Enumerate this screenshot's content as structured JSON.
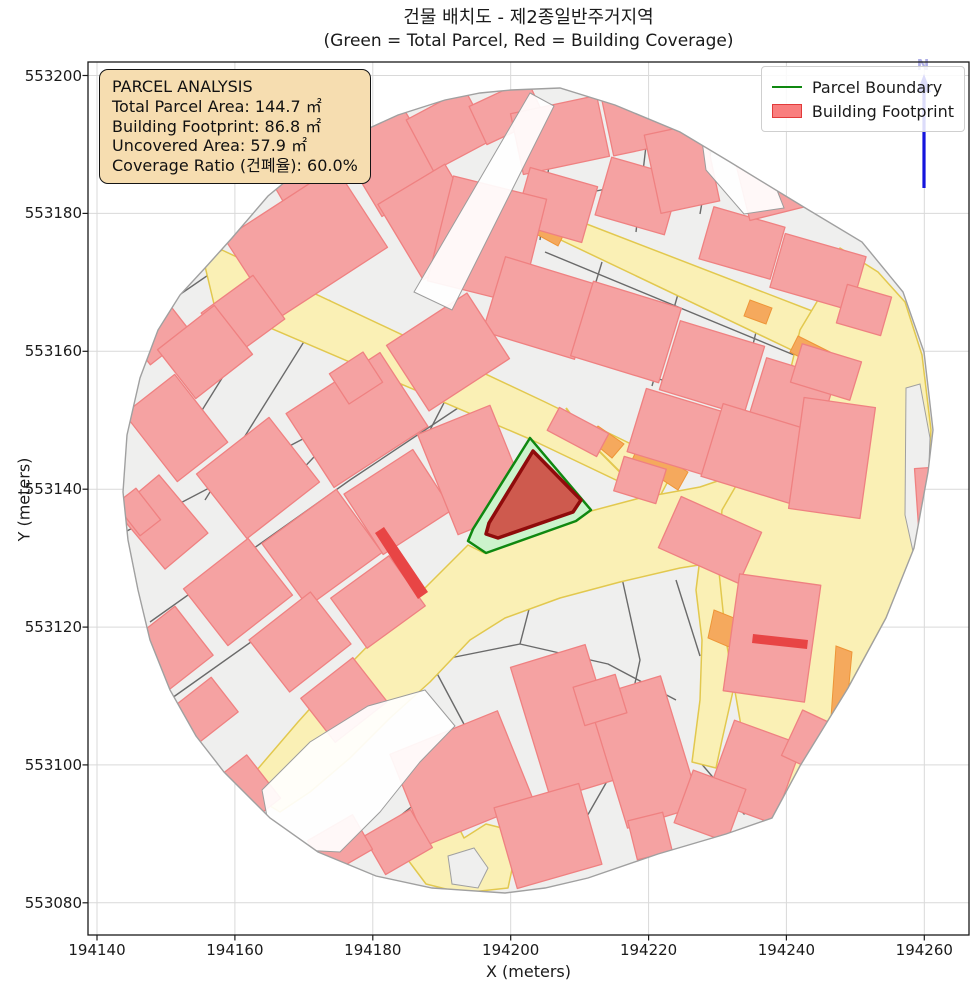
{
  "title": {
    "line1": "건물 배치도 - 제2종일반주거지역",
    "line2": "(Green = Total Parcel, Red = Building Coverage)"
  },
  "axes": {
    "xlabel": "X (meters)",
    "ylabel": "Y (meters)",
    "x_ticks": [
      {
        "label": "194140",
        "px": 97.0
      },
      {
        "label": "194160",
        "px": 234.9
      },
      {
        "label": "194180",
        "px": 372.8
      },
      {
        "label": "194200",
        "px": 510.7
      },
      {
        "label": "194220",
        "px": 648.6
      },
      {
        "label": "194240",
        "px": 786.4
      },
      {
        "label": "194260",
        "px": 924.3
      }
    ],
    "y_ticks": [
      {
        "label": "553200",
        "px": 75.5
      },
      {
        "label": "553180",
        "px": 213.4
      },
      {
        "label": "553160",
        "px": 351.3
      },
      {
        "label": "553140",
        "px": 489.2
      },
      {
        "label": "553120",
        "px": 627.1
      },
      {
        "label": "553100",
        "px": 764.9
      },
      {
        "label": "553080",
        "px": 902.8
      }
    ]
  },
  "legend": {
    "items": [
      {
        "label": "Parcel Boundary",
        "swatch": "line"
      },
      {
        "label": "Building Footprint",
        "swatch": "patch"
      }
    ]
  },
  "info_box": {
    "title": "PARCEL ANALYSIS",
    "lines": [
      "Total Parcel Area: 144.7 ㎡",
      "Building Footprint: 86.8 ㎡",
      "Uncovered Area: 57.9 ㎡",
      "Coverage Ratio (건폐율): 60.0%"
    ]
  },
  "north_label": "N",
  "theme": {
    "grid": "#d9d9d9",
    "base": "#efefee",
    "edge": "#a0a0a0",
    "street": "#6a6a6a",
    "road": "#faf0b5",
    "roadedge": "#e2c84e",
    "orange": "#f5a95d",
    "orangeedge": "#ee9537",
    "bld": "#f5a2a2",
    "bldedge": "#ef8181",
    "redsliver": "#e84545",
    "pgreen": "#ccf3cc",
    "pgreenedge": "#0f8810",
    "hbld": "#ce5a4e",
    "hbldedge": "#8f0b0b",
    "legbld": "#f97e7e",
    "legbldedge": "#e23b3b",
    "infobg": "#f6ddb0",
    "narrow": "#1515dd"
  },
  "map": {
    "boundary": [
      511,
      90,
      560,
      88,
      615,
      105,
      680,
      132,
      730,
      162,
      807,
      209,
      862,
      242,
      903,
      292,
      924,
      352,
      933,
      430,
      928,
      472,
      914,
      548,
      886,
      618,
      848,
      688,
      800,
      766,
      772,
      818,
      726,
      834,
      658,
      854,
      588,
      878,
      545,
      888,
      505,
      893,
      432,
      888,
      376,
      876,
      318,
      852,
      270,
      818,
      224,
      772,
      196,
      736,
      170,
      690,
      150,
      640,
      138,
      590,
      128,
      540,
      123,
      492,
      127,
      435,
      140,
      378,
      158,
      330,
      180,
      295,
      205,
      268,
      232,
      238,
      268,
      196,
      308,
      163,
      352,
      136,
      398,
      115,
      445,
      100,
      480,
      93
    ],
    "streets": [
      [
        150,
        315,
        300,
        212,
        450,
        115
      ],
      [
        210,
        196,
        250,
        262
      ],
      [
        320,
        140,
        360,
        225
      ],
      [
        430,
        108,
        395,
        180
      ],
      [
        512,
        208,
        700,
        170
      ],
      [
        556,
        106,
        540,
        240
      ],
      [
        652,
        94,
        636,
        232
      ],
      [
        716,
        122,
        700,
        214
      ],
      [
        545,
        252,
        840,
        374
      ],
      [
        562,
        338,
        852,
        460
      ],
      [
        602,
        262,
        574,
        354
      ],
      [
        678,
        294,
        652,
        386
      ],
      [
        758,
        324,
        736,
        414
      ],
      [
        826,
        352,
        808,
        442
      ],
      [
        125,
        532,
        320,
        430,
        462,
        352
      ],
      [
        150,
        622,
        350,
        480,
        470,
        400
      ],
      [
        172,
        698,
        420,
        522,
        468,
        486
      ],
      [
        252,
        330,
        176,
        452
      ],
      [
        330,
        300,
        250,
        428,
        205,
        500
      ],
      [
        398,
        338,
        330,
        440,
        262,
        512
      ],
      [
        465,
        362,
        430,
        430
      ],
      [
        320,
        700,
        430,
        662,
        520,
        644,
        608,
        664,
        676,
        700
      ],
      [
        520,
        644,
        534,
        590
      ],
      [
        618,
        560,
        640,
        660,
        618,
        762,
        562,
        860
      ],
      [
        676,
        580,
        700,
        656
      ],
      [
        432,
        664,
        466,
        728
      ],
      [
        352,
        854,
        420,
        800,
        466,
        770
      ],
      [
        756,
        560,
        830,
        602,
        866,
        652
      ],
      [
        820,
        608,
        790,
        700,
        772,
        760
      ],
      [
        700,
        762,
        744,
        814,
        788,
        790
      ],
      [
        447,
        280,
        540,
        306
      ]
    ],
    "roads": [
      [
        204,
        262,
        222,
        250,
        545,
        402,
        676,
        466,
        658,
        500,
        532,
        440,
        214,
        304
      ],
      [
        540,
        206,
        820,
        314,
        842,
        330,
        800,
        354,
        544,
        232
      ],
      [
        744,
        472,
        722,
        512,
        718,
        562,
        680,
        568,
        620,
        582,
        560,
        598,
        505,
        618,
        470,
        640,
        430,
        682,
        390,
        718,
        350,
        758,
        310,
        792,
        280,
        812,
        252,
        795,
        250,
        778,
        298,
        722,
        352,
        662,
        405,
        608,
        445,
        568,
        468,
        545,
        484,
        553,
        540,
        532,
        591,
        511,
        640,
        498,
        700,
        487
      ],
      [
        700,
        558,
        738,
        556,
        748,
        600,
        740,
        660,
        722,
        740,
        716,
        768,
        692,
        762,
        700,
        700,
        702,
        640,
        696,
        590
      ],
      [
        408,
        860,
        444,
        820,
        454,
        818,
        464,
        838,
        486,
        824,
        502,
        828,
        514,
        860,
        508,
        888,
        462,
        893,
        426,
        884
      ],
      [
        840,
        248,
        878,
        272,
        905,
        302,
        922,
        355,
        931,
        430,
        928,
        472,
        915,
        548,
        886,
        618,
        848,
        688,
        800,
        766,
        774,
        818,
        750,
        800,
        740,
        720,
        726,
        640,
        718,
        562,
        722,
        510,
        744,
        472,
        770,
        425,
        788,
        380,
        800,
        330,
        818,
        300,
        828,
        270
      ]
    ],
    "yellow_lines": [
      [
        566,
        408,
        592,
        444,
        636,
        488
      ]
    ],
    "orange": [
      [
        540,
        220,
        566,
        230,
        558,
        246,
        536,
        234
      ],
      [
        750,
        300,
        772,
        308,
        766,
        324,
        744,
        316
      ],
      [
        798,
        336,
        830,
        352,
        820,
        368,
        790,
        352
      ],
      [
        598,
        426,
        624,
        444,
        612,
        458,
        588,
        438
      ],
      [
        640,
        443,
        688,
        472,
        678,
        490,
        632,
        460
      ],
      [
        851,
        406,
        865,
        410,
        860,
        474,
        847,
        470
      ],
      [
        682,
        508,
        748,
        528,
        742,
        546,
        676,
        526
      ],
      [
        714,
        610,
        744,
        622,
        736,
        650,
        708,
        638
      ],
      [
        836,
        646,
        852,
        652,
        844,
        738,
        830,
        732
      ],
      [
        306,
        642,
        322,
        650,
        314,
        664,
        298,
        656
      ]
    ],
    "gray_patches": [
      [
        448,
        856,
        474,
        848,
        488,
        868,
        478,
        888,
        452,
        884
      ],
      [
        906,
        388,
        920,
        384,
        930,
        438,
        927,
        515,
        914,
        556,
        905,
        515
      ]
    ],
    "buildings": [
      [
        172,
        243,
        64,
        50,
        -34
      ],
      [
        216,
        186,
        70,
        52,
        -34
      ],
      [
        310,
        168,
        80,
        50,
        -30
      ],
      [
        306,
        243,
        132,
        96,
        -33
      ],
      [
        390,
        158,
        74,
        92,
        -31
      ],
      [
        449,
        130,
        66,
        58,
        -28
      ],
      [
        434,
        222,
        78,
        88,
        -31
      ],
      [
        150,
        322,
        52,
        68,
        -38
      ],
      [
        243,
        316,
        64,
        54,
        -36
      ],
      [
        507,
        112,
        64,
        42,
        -25
      ],
      [
        560,
        135,
        88,
        62,
        -12
      ],
      [
        648,
        120,
        82,
        56,
        -12
      ],
      [
        556,
        205,
        70,
        58,
        16
      ],
      [
        638,
        196,
        72,
        60,
        16
      ],
      [
        682,
        168,
        60,
        80,
        -12
      ],
      [
        742,
        243,
        74,
        54,
        16
      ],
      [
        780,
        180,
        78,
        64,
        -14
      ],
      [
        818,
        272,
        84,
        56,
        16
      ],
      [
        864,
        310,
        46,
        40,
        16
      ],
      [
        487,
        240,
        96,
        108,
        14
      ],
      [
        540,
        308,
        96,
        78,
        17
      ],
      [
        626,
        332,
        92,
        78,
        17
      ],
      [
        712,
        368,
        88,
        72,
        17
      ],
      [
        792,
        398,
        72,
        62,
        17
      ],
      [
        448,
        352,
        96,
        78,
        -33
      ],
      [
        357,
        420,
        112,
        88,
        -33
      ],
      [
        356,
        378,
        40,
        36,
        -33
      ],
      [
        205,
        352,
        72,
        62,
        -38
      ],
      [
        176,
        428,
        64,
        86,
        -38
      ],
      [
        258,
        478,
        92,
        82,
        -38
      ],
      [
        162,
        522,
        56,
        76,
        -40
      ],
      [
        238,
        592,
        82,
        72,
        -38
      ],
      [
        322,
        548,
        92,
        78,
        -36
      ],
      [
        398,
        502,
        82,
        72,
        -33
      ],
      [
        474,
        470,
        78,
        108,
        -22
      ],
      [
        300,
        642,
        78,
        66,
        -38
      ],
      [
        378,
        602,
        72,
        62,
        -36
      ],
      [
        344,
        700,
        66,
        56,
        -38
      ],
      [
        462,
        778,
        116,
        98,
        -22
      ],
      [
        568,
        722,
        78,
        138,
        -17
      ],
      [
        644,
        752,
        76,
        136,
        -17
      ],
      [
        548,
        836,
        88,
        84,
        -16
      ],
      [
        600,
        700,
        44,
        40,
        -17
      ],
      [
        398,
        842,
        54,
        44,
        -30
      ],
      [
        650,
        836,
        36,
        40,
        -14
      ],
      [
        710,
        540,
        88,
        56,
        24
      ],
      [
        772,
        638,
        82,
        118,
        8
      ],
      [
        754,
        772,
        72,
        84,
        20
      ],
      [
        710,
        806,
        56,
        56,
        20
      ],
      [
        812,
        742,
        44,
        50,
        25
      ],
      [
        676,
        432,
        82,
        66,
        17
      ],
      [
        758,
        454,
        96,
        76,
        17
      ],
      [
        832,
        458,
        72,
        112,
        8
      ],
      [
        826,
        372,
        62,
        40,
        17
      ],
      [
        925,
        504,
        16,
        72,
        -4
      ],
      [
        172,
        648,
        56,
        62,
        -38
      ],
      [
        205,
        710,
        50,
        44,
        -38
      ],
      [
        640,
        480,
        44,
        36,
        17
      ],
      [
        578,
        432,
        56,
        26,
        28
      ],
      [
        138,
        512,
        26,
        40,
        -38
      ],
      [
        240,
        795,
        60,
        55,
        -38
      ],
      [
        340,
        845,
        52,
        40,
        -30
      ]
    ],
    "red_slivers": [
      [
        375,
        533,
        384,
        527,
        428,
        592,
        418,
        599
      ],
      [
        753,
        634,
        808,
        640,
        807,
        649,
        752,
        643
      ]
    ],
    "white_gaps": [
      [
        530,
        93,
        554,
        106,
        452,
        310,
        414,
        292
      ],
      [
        262,
        790,
        310,
        742,
        368,
        706,
        425,
        690,
        455,
        726,
        420,
        762,
        380,
        812,
        340,
        852,
        300,
        850,
        268,
        822
      ],
      [
        700,
        126,
        762,
        152,
        784,
        208,
        744,
        214,
        706,
        170
      ]
    ],
    "highlight": {
      "parcel": [
        530,
        438,
        591,
        510,
        576,
        521,
        486,
        553,
        468,
        541,
        473,
        529
      ],
      "building": [
        533,
        451,
        581,
        500,
        573,
        512,
        498,
        538,
        486,
        534,
        489,
        523
      ]
    },
    "north": {
      "shaft": [
        924,
        86,
        924,
        188
      ],
      "head": [
        924,
        74,
        917,
        92,
        931,
        92
      ],
      "label_xy": [
        923,
        70
      ]
    }
  },
  "chart_data": {
    "type": "map",
    "title": "건물 배치도 - 제2종일반주거지역 (Green = Total Parcel, Red = Building Coverage)",
    "xlabel": "X (meters)",
    "ylabel": "Y (meters)",
    "xlim": [
      194138,
      194267
    ],
    "ylim": [
      553075,
      553202
    ],
    "x_tick_values": [
      194140,
      194160,
      194180,
      194200,
      194220,
      194240,
      194260
    ],
    "y_tick_values": [
      553200,
      553180,
      553160,
      553140,
      553120,
      553100,
      553080
    ],
    "legend_entries": [
      "Parcel Boundary",
      "Building Footprint"
    ],
    "parcel_analysis": {
      "total_parcel_area_m2": 144.7,
      "building_footprint_m2": 86.8,
      "uncovered_area_m2": 57.9,
      "coverage_ratio_pct": 60.0,
      "coverage_ratio_label": "건폐율"
    },
    "grid": true,
    "legend_position": "upper right"
  }
}
